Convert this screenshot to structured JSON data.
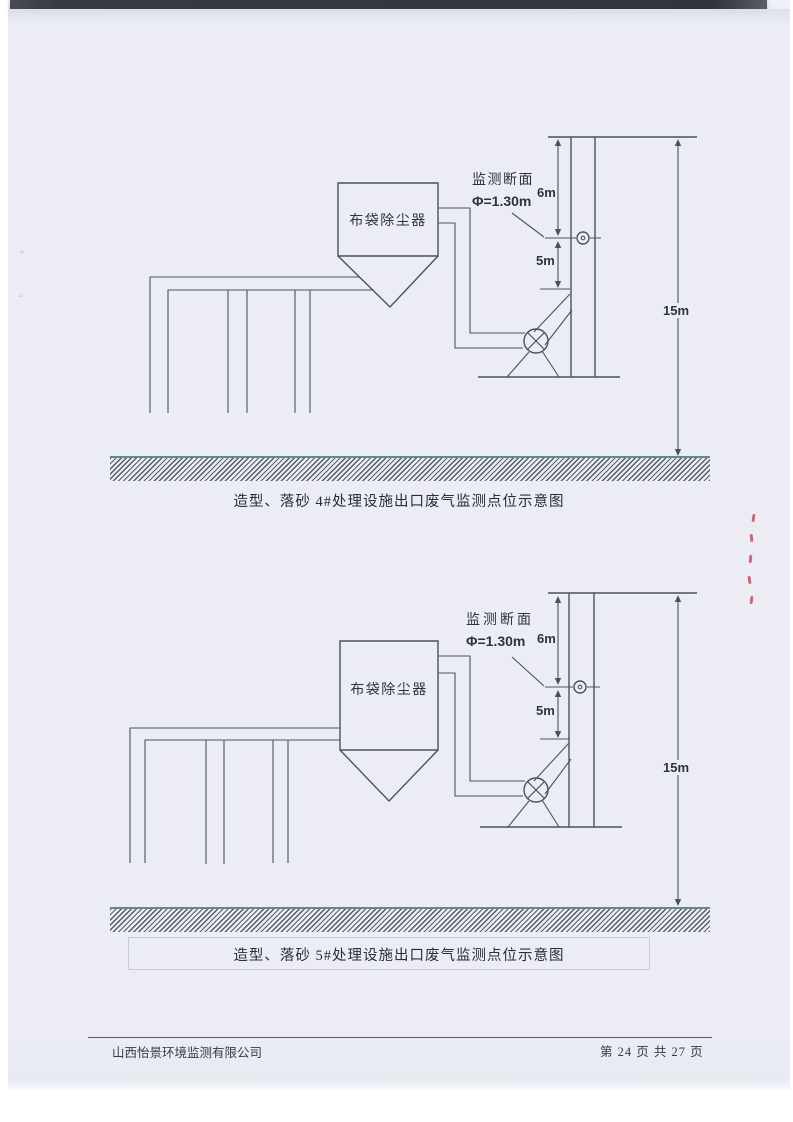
{
  "page": {
    "diagrams": [
      {
        "equipment": "布袋除尘器",
        "monitor_section": "监测断面",
        "diameter": "Φ=1.30m",
        "dim_upper": "6m",
        "dim_lower": "5m",
        "dim_total": "15m",
        "caption": "造型、落砂 4#处理设施出口废气监测点位示意图"
      },
      {
        "equipment": "布袋除尘器",
        "monitor_section": "监测断面",
        "diameter": "Φ=1.30m",
        "dim_upper": "6m",
        "dim_lower": "5m",
        "dim_total": "15m",
        "caption": "造型、落砂 5#处理设施出口废气监测点位示意图"
      }
    ],
    "footer": {
      "company": "山西怡景环境监测有限公司",
      "page_number": "第 24 页 共 27 页"
    }
  },
  "colors": {
    "line": "#4a5260",
    "text": "#2c3440",
    "page_bg": "#ecedf4",
    "ground_hatch": "#565e68",
    "red_mark": "#ba3e4e"
  }
}
